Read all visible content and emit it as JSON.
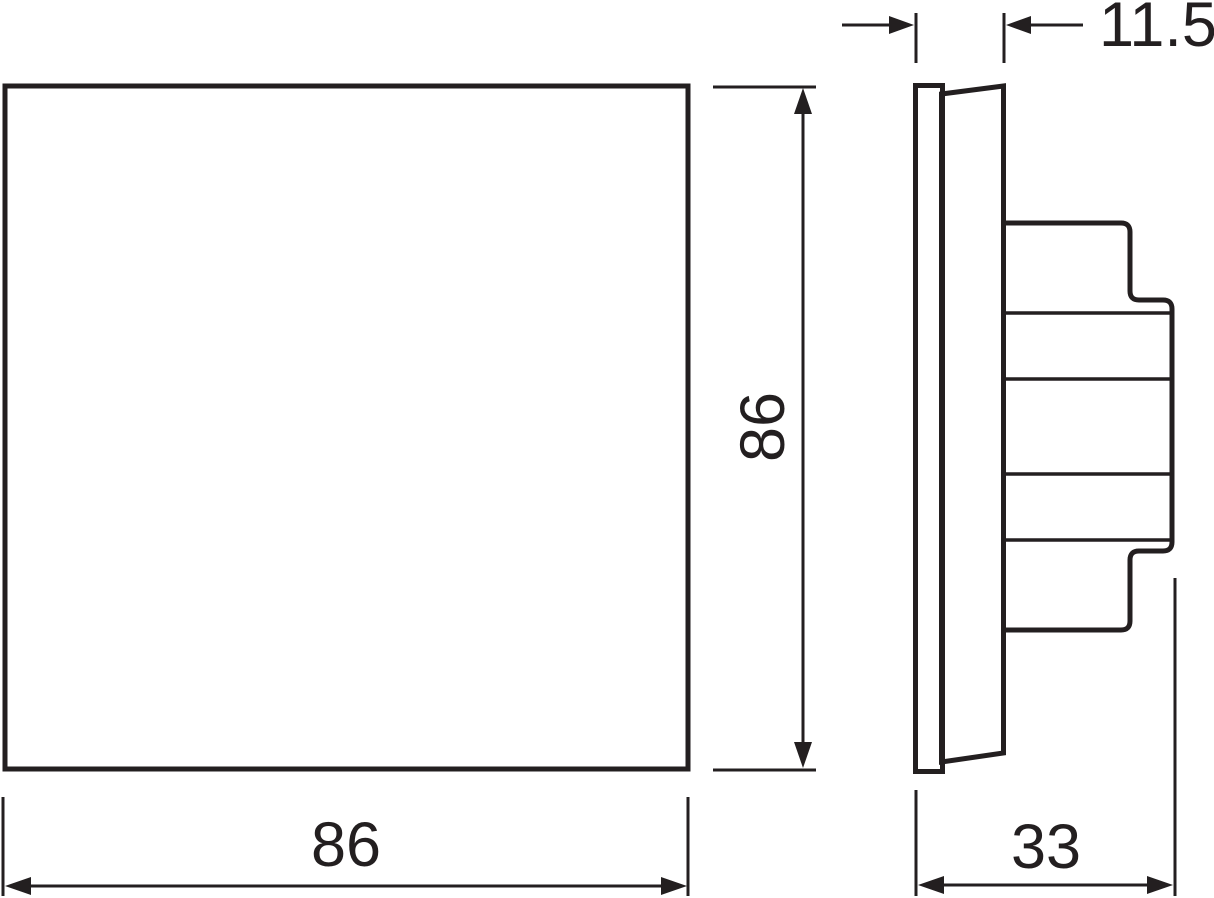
{
  "drawing": {
    "kind": "technical dimension drawing, front and side view",
    "front_view": {
      "shape": "square",
      "width": {
        "label": "86"
      },
      "height": {
        "label": "86"
      }
    },
    "side_view": {
      "total_depth": {
        "label": "33"
      },
      "front_depth": {
        "label": "11.5"
      }
    },
    "colors": {
      "line": "#231f20",
      "background": "#ffffff"
    }
  }
}
